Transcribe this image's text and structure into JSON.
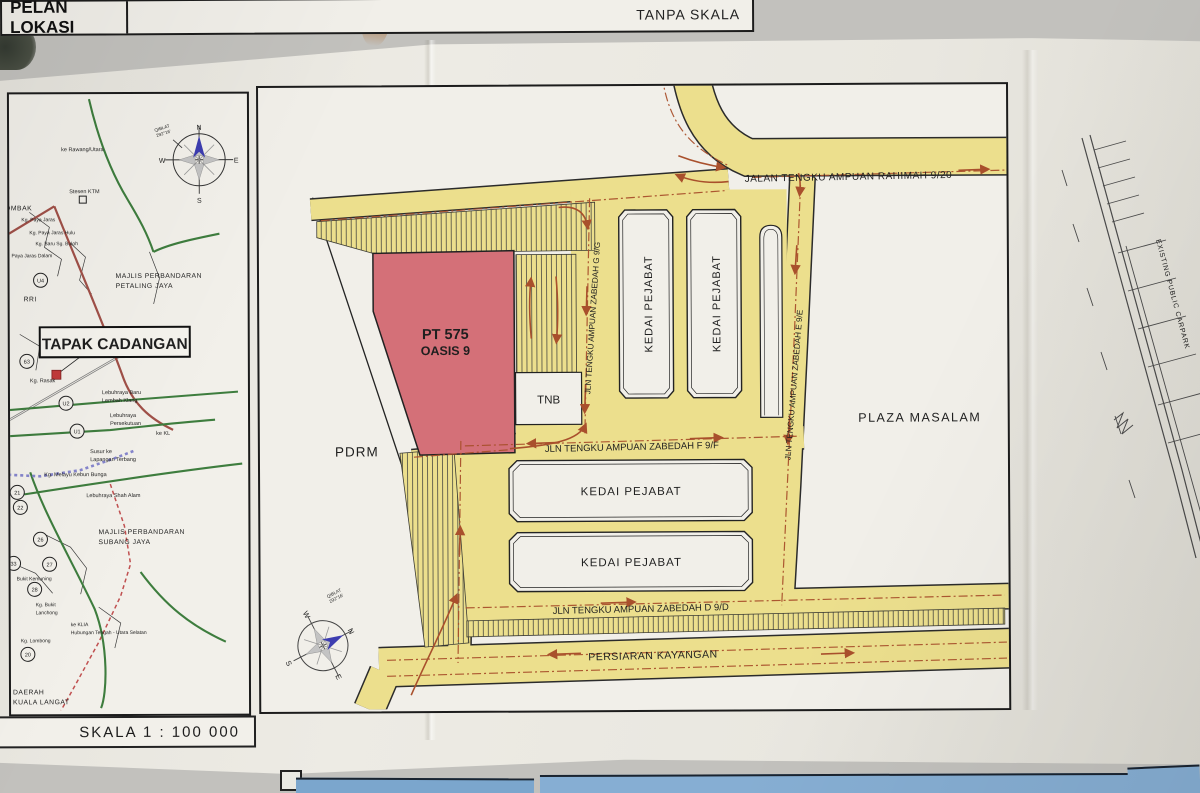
{
  "left_panel": {
    "title": "TAPAK CADANGAN",
    "scale_label": "SKALA 1 : 100 000",
    "compass": {
      "n": "N",
      "e": "E",
      "s": "S",
      "w": "W",
      "qiblat_line1": "QIBLAT",
      "qiblat_line2": "292°16'"
    },
    "labels": {
      "ke_rawang": "ke Rawang/Utara",
      "gombak": "GOMBAK",
      "stesen_ktm": "Stesen KTM",
      "kg_paya_jaras": "Kg. Paya Jaras",
      "kg_paya_jaras_hulu": "Kg. Paya Jaras Hulu",
      "kg_baru_sg_buloh": "Kg. Baru Sg. Buloh",
      "paya_jaras_dalam": "Paya Jaras Dalam",
      "rri": "RRI",
      "mpp_line1": "MAJLIS PERBANDARAN",
      "mpp_line2": "PETALING JAYA",
      "kg_rasak": "Kg. Rasak",
      "leb_baru_line1": "Lebuhraya Baru",
      "leb_baru_line2": "Lembah Klang",
      "leb_per_line1": "Lebuhraya",
      "leb_per_line2": "Persekutuan",
      "ke_kl": "ke KL",
      "susur_line1": "Susur ke",
      "susur_line2": "Lapangan Terbang",
      "kg_melayu": "Kg. Melayu Kebun Bunga",
      "leb_shah_alam": "Lebuhraya Shah Alam",
      "mps_line1": "MAJLIS PERBANDARAN",
      "mps_line2": "SUBANG JAYA",
      "bukit_kemuning": "Bukit Kemuning",
      "kg_bukit_line1": "Kg. Bukit",
      "kg_bukit_line2": "Lanchong",
      "ke_klia": "ke KLIA",
      "hubungan": "Hubungan Tengah - Utara Selatan",
      "kg_lombong": "Kg. Lombong",
      "daerah_line1": "DAERAH",
      "daerah_line2": "KUALA LANGAT"
    },
    "badges": [
      "63",
      "U2",
      "U1",
      "21",
      "22",
      "26",
      "33",
      "27",
      "28",
      "20",
      "U4"
    ]
  },
  "main_panel": {
    "title": "PELAN LOKASI",
    "scale_label": "TANPA SKALA",
    "site": {
      "line1": "PT 575",
      "line2": "OASIS 9"
    },
    "roads": {
      "rahimah": "JALAN TENGKU AMPUAN RAHIMAH 9/20",
      "zabedah_g": "JLN TENGKU AMPUAN ZABEDAH G 9/G",
      "zabedah_e": "JLN TENGKU AMPUAN ZABEDAH E 9/E",
      "zabedah_f": "JLN TENGKU AMPUAN ZABEDAH F 9/F",
      "zabedah_d": "JLN TENGKU AMPUAN ZABEDAH D 9/D",
      "kayangan": "PERSIARAN KAYANGAN"
    },
    "places": {
      "kedai_pejabat": "KEDAI PEJABAT",
      "tnb": "TNB",
      "pdrm": "PDRM",
      "plaza": "PLAZA MASALAM"
    },
    "compass": {
      "n": "N",
      "e": "E",
      "s": "S",
      "w": "W",
      "qiblat_line1": "QIBLAT",
      "qiblat_line2": "292°16'"
    }
  },
  "side_sheet": {
    "carpark_label": "EXISTING PUBLIC CARPARK"
  },
  "colors": {
    "road_yellow": "#ecdf8d",
    "site_red": "#d47078",
    "arrow_red": "#a9502c",
    "paper": "#edebe4",
    "rail_blue": "#8585cc",
    "highway_green": "#3e7d3e"
  }
}
